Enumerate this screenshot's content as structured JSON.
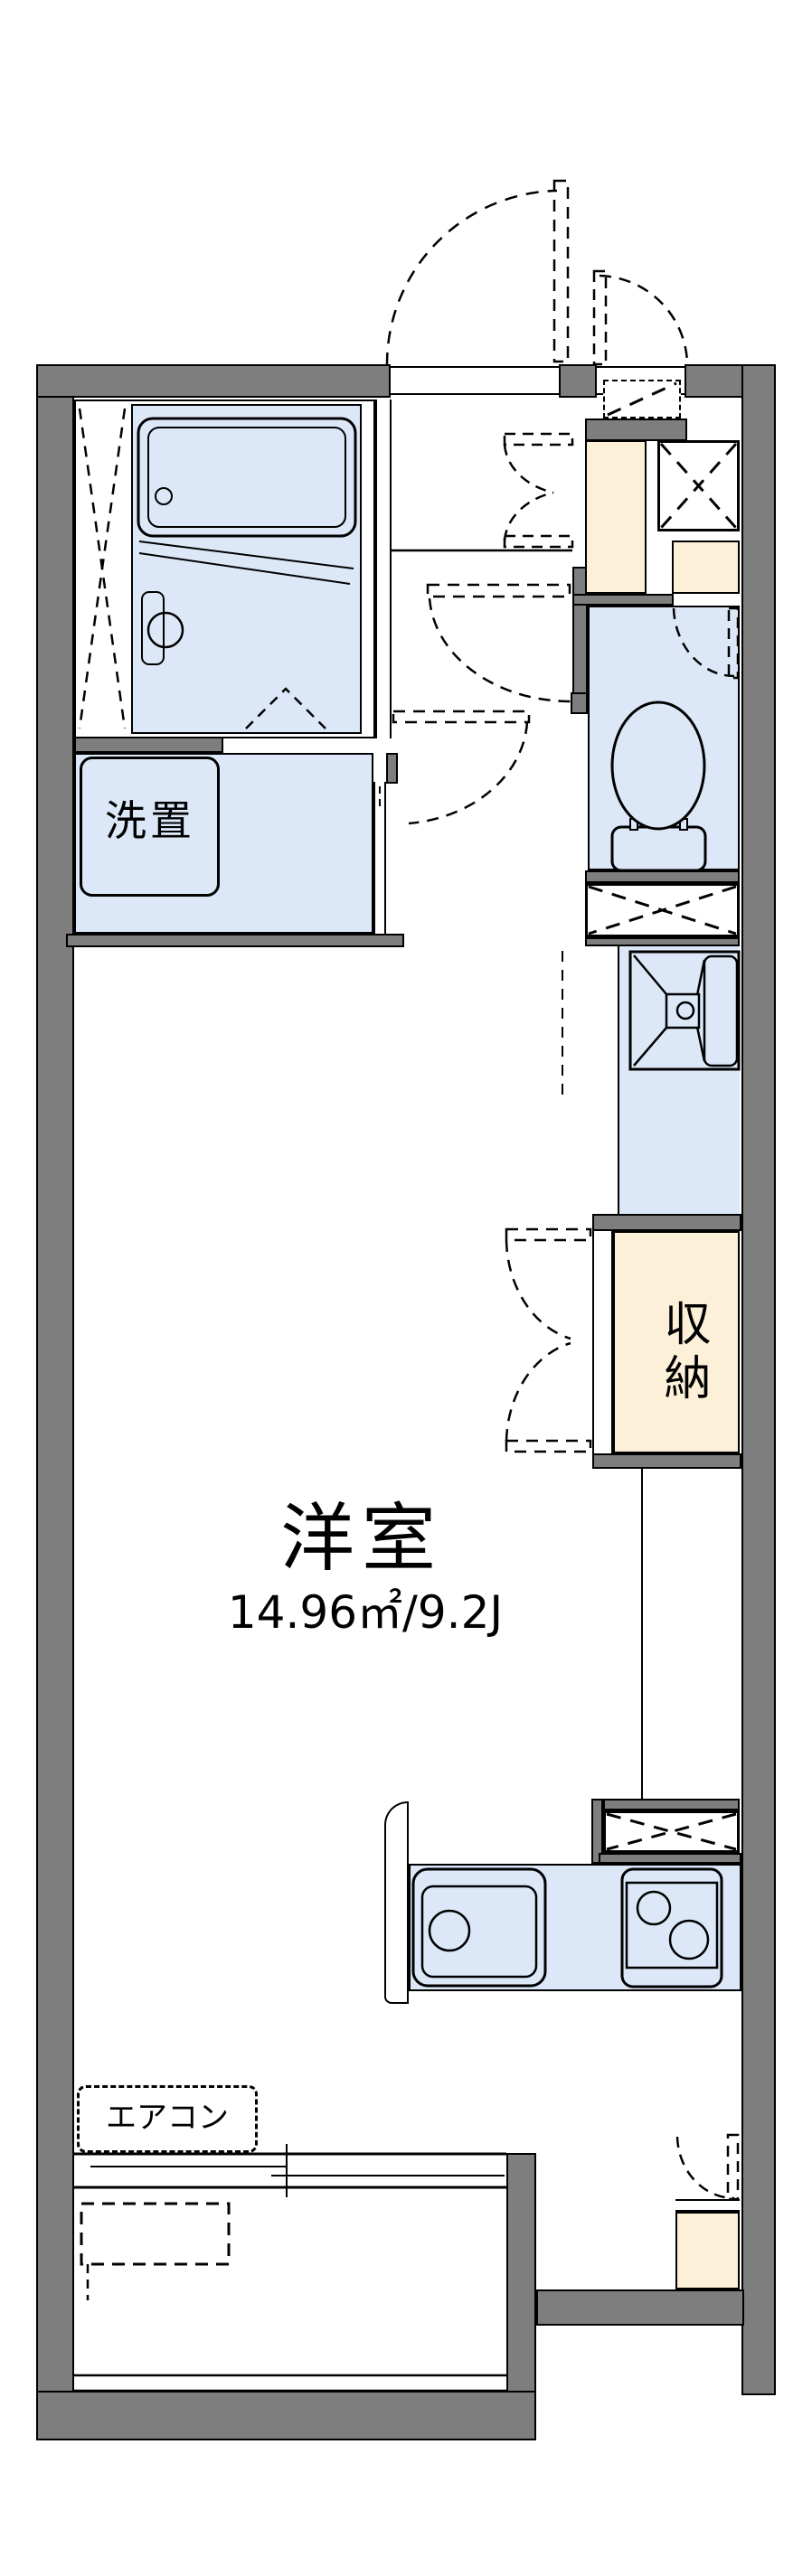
{
  "floorplan": {
    "labels": {
      "main_room": "洋室",
      "main_room_size": "14.96㎡/9.2J",
      "laundry": "洗置",
      "storage": "収納",
      "aircon": "エアコン"
    },
    "colors": {
      "wall_gray": "#7e7e7e",
      "room_blue": "#dce8f8",
      "cabinet_cream": "#fcf0d8",
      "line_black": "#000000",
      "background": "#ffffff"
    },
    "fixtures": [
      "bathtub",
      "folding-bath-door",
      "washing-machine-place",
      "toilet",
      "washbasin",
      "storage-closet",
      "kitchen-sink",
      "gas-stove",
      "range-hood-vent",
      "meter-box",
      "pipe-space",
      "sliding-window",
      "air-conditioner",
      "outdoor-unit",
      "entrance-door"
    ]
  }
}
